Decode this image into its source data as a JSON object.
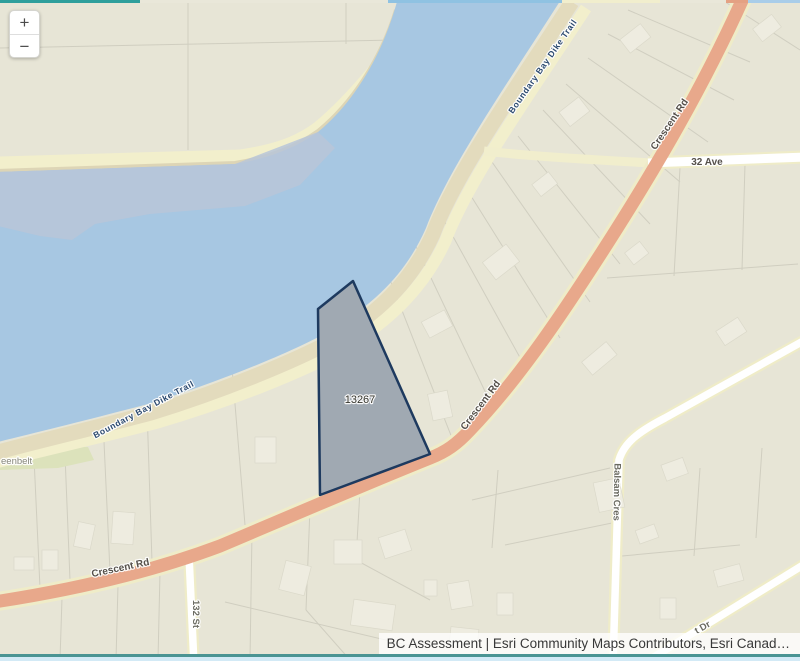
{
  "map": {
    "zoom_in_label": "+",
    "zoom_out_label": "−",
    "selected_parcel": {
      "id": "13267"
    },
    "trail_label": "Boundary Bay Dike Trail",
    "road_labels": {
      "crescent_rd": "Crescent Rd",
      "thirtytwo_ave": "32 Ave",
      "balsam_cres": "Balsam Cres",
      "one_thirtytwo_st": "132 St",
      "t_dr_fragment": "t Dr"
    },
    "greenbelt_label_fragment": "eenbelt",
    "attribution": "BC Assessment | Esri Community Maps Contributors, Esri Canad…",
    "colors": {
      "land": "#e7e5d6",
      "water": "#a7c7e2",
      "shallow_water": "#b9c6d8",
      "beach": "#e3dbbd",
      "trail": "#f2efcc",
      "major_road": "#e8a88b",
      "minor_road": "#ffffff",
      "selected_parcel_fill": "#a0a9b2",
      "selected_parcel_border": "#1e3a5f",
      "frame_teal": "#2f9f9c"
    }
  }
}
